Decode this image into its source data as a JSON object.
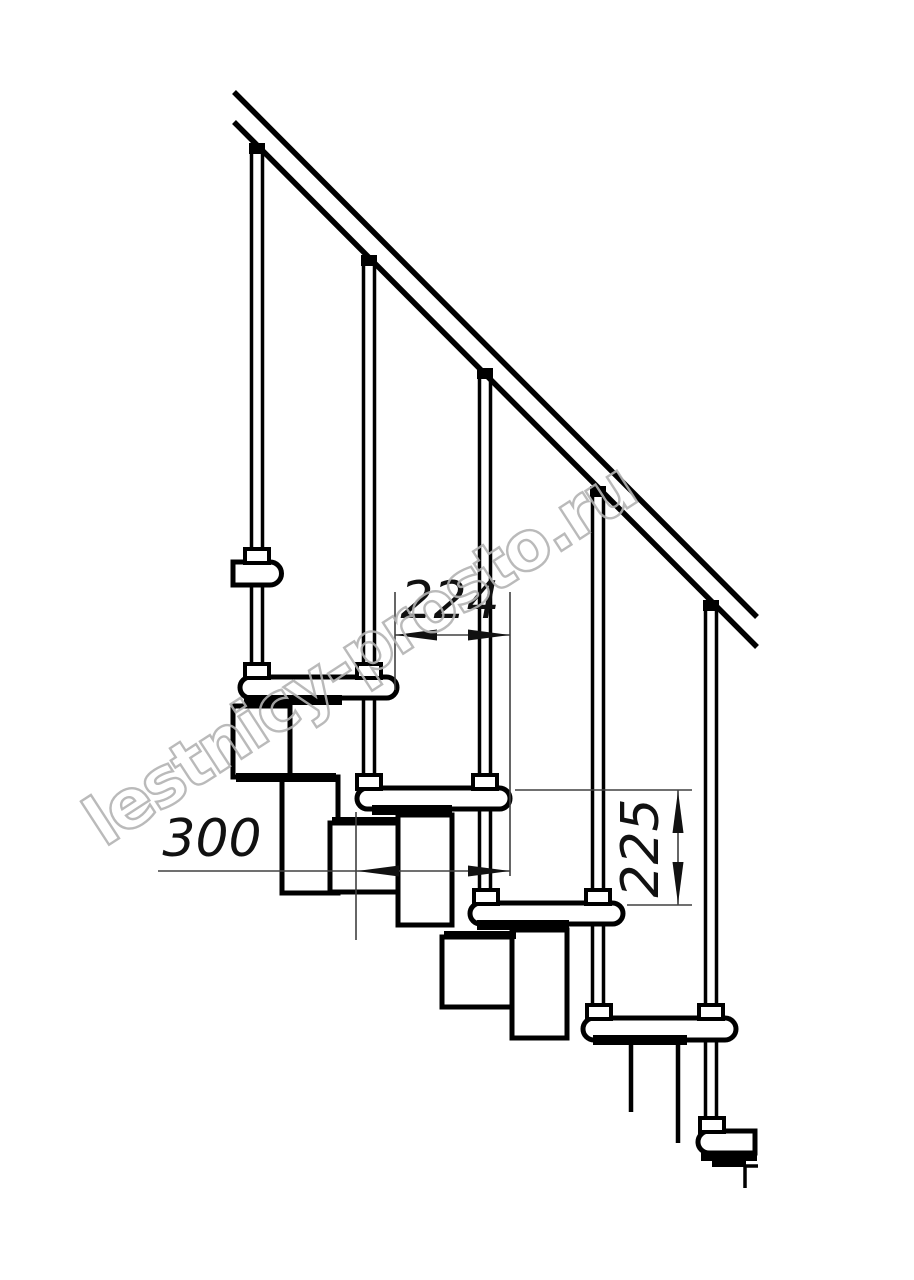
{
  "drawing": {
    "dimensions": {
      "step_run": "224",
      "tread_depth": "300",
      "step_rise": "225"
    },
    "watermark": {
      "text": "lestnicy-prosto.ru",
      "color": "#b3b3b3"
    },
    "colors": {
      "line": "#000000",
      "dimension_line": "#404040",
      "background": "#ffffff"
    }
  }
}
